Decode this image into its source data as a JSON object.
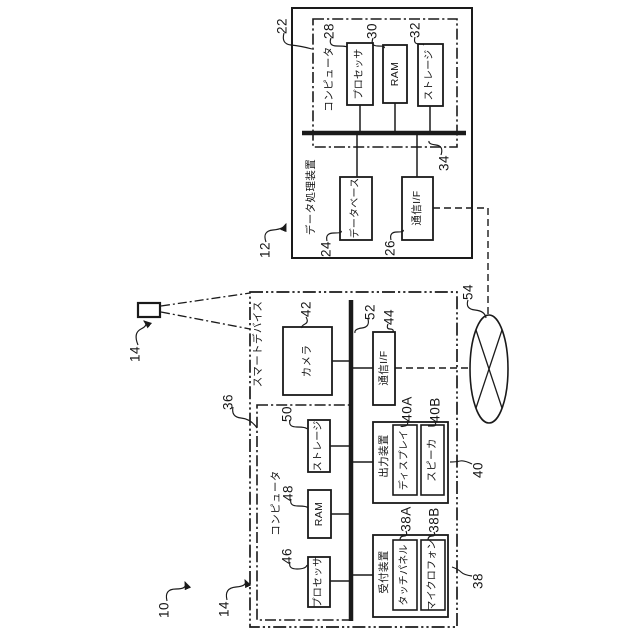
{
  "diagram": {
    "system_ref": "10",
    "device_icon_ref": "14",
    "network": {
      "ref": "54"
    },
    "dpd": {
      "ref": "12",
      "label": "データ処理装置",
      "computer": {
        "ref": "22",
        "label": "コンピュータ"
      },
      "processor": {
        "ref": "28",
        "label": "プロセッサ"
      },
      "ram": {
        "ref": "30",
        "label": "RAM"
      },
      "storage": {
        "ref": "32",
        "label": "ストレージ"
      },
      "bus": {
        "ref": "34"
      },
      "database": {
        "ref": "24",
        "label": "データベース"
      },
      "comm_if": {
        "ref": "26",
        "label": "通信I/F"
      }
    },
    "smart_device": {
      "ref": "14",
      "label": "スマートデバイス",
      "camera": {
        "ref": "42",
        "label": "カメラ"
      },
      "bus": {
        "ref": "52"
      },
      "comm_if": {
        "ref": "44",
        "label": "通信I/F"
      },
      "computer": {
        "ref": "36",
        "label": "コンピュータ",
        "processor": {
          "ref": "46",
          "label": "プロセッサ"
        },
        "ram": {
          "ref": "48",
          "label": "RAM"
        },
        "storage": {
          "ref": "50",
          "label": "ストレージ"
        }
      },
      "output_device": {
        "ref": "40",
        "label": "出力装置",
        "display": {
          "ref": "40A",
          "label": "ディスプレイ"
        },
        "speaker": {
          "ref": "40B",
          "label": "スピーカ"
        }
      },
      "reception_device": {
        "ref": "38",
        "label": "受付装置",
        "touch_panel": {
          "ref": "38A",
          "label": "タッチパネル"
        },
        "microphone": {
          "ref": "38B",
          "label": "マイクロフォン"
        }
      }
    },
    "colors": {
      "ink": "#1a1a1a",
      "background": "#ffffff"
    }
  }
}
